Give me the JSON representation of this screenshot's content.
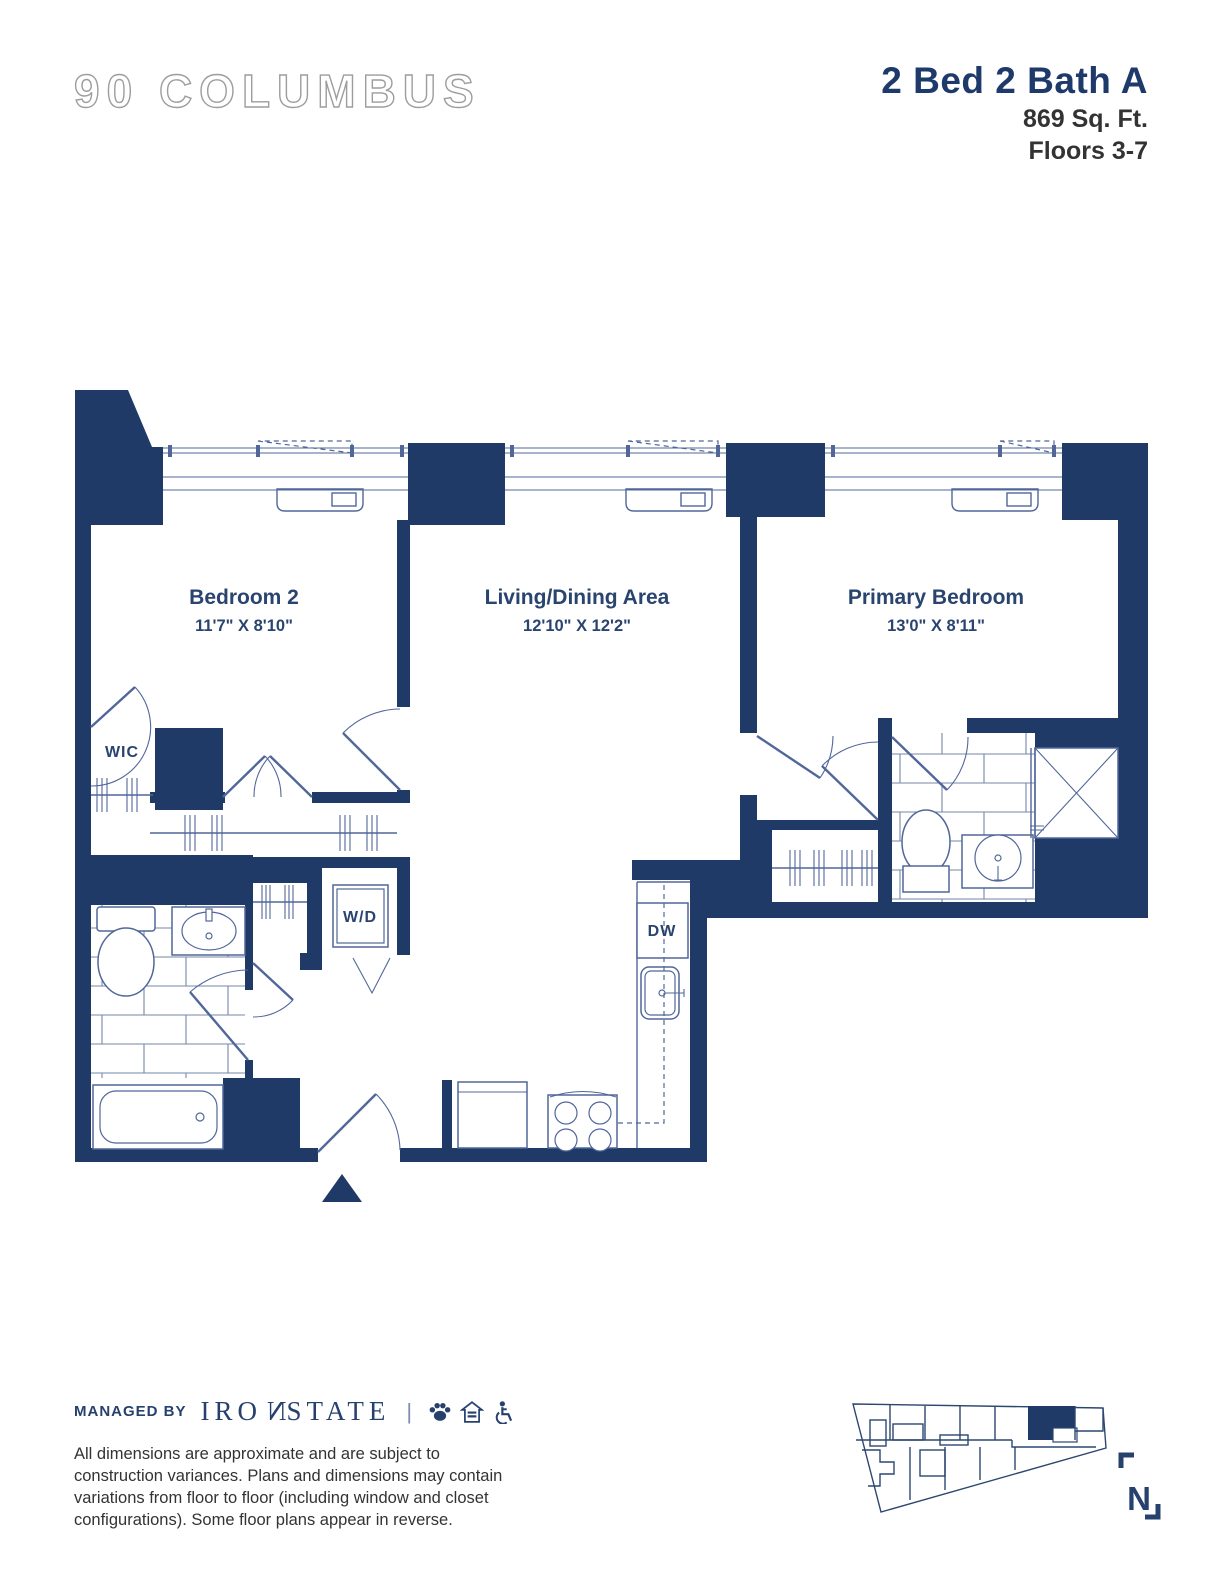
{
  "header": {
    "logo": "90 COLUMBUS",
    "unit_title": "2 Bed 2 Bath A",
    "area": "869 Sq. Ft.",
    "floors": "Floors 3-7"
  },
  "plan": {
    "rooms": [
      {
        "name": "Bedroom 2",
        "dims": "11'7\" X 8'10\""
      },
      {
        "name": "Living/Dining Area",
        "dims": "12'10\" X 12'2\""
      },
      {
        "name": "Primary Bedroom",
        "dims": "13'0\" X 8'11\""
      }
    ],
    "labels": {
      "wic": "WIC",
      "wd": "W/D",
      "dw": "DW"
    }
  },
  "compass": {
    "letter": "N"
  },
  "footer": {
    "managed_by": "MANAGED BY",
    "brand_pre": "IRO",
    "brand_n": "N",
    "brand_post": "STATE",
    "divider": "|",
    "icons": [
      "paw-icon",
      "equal-housing-icon",
      "accessibility-icon"
    ],
    "disclaimer": "All dimensions are approximate and are subject to construction variances. Plans and dimensions may contain variations from floor to floor (including window and closet configurations). Some floor plans appear in reverse."
  },
  "colors": {
    "navy": "#1f3a67",
    "line": "#51679a",
    "text_dark": "#333333",
    "logo_gray": "#a6a6a6"
  }
}
